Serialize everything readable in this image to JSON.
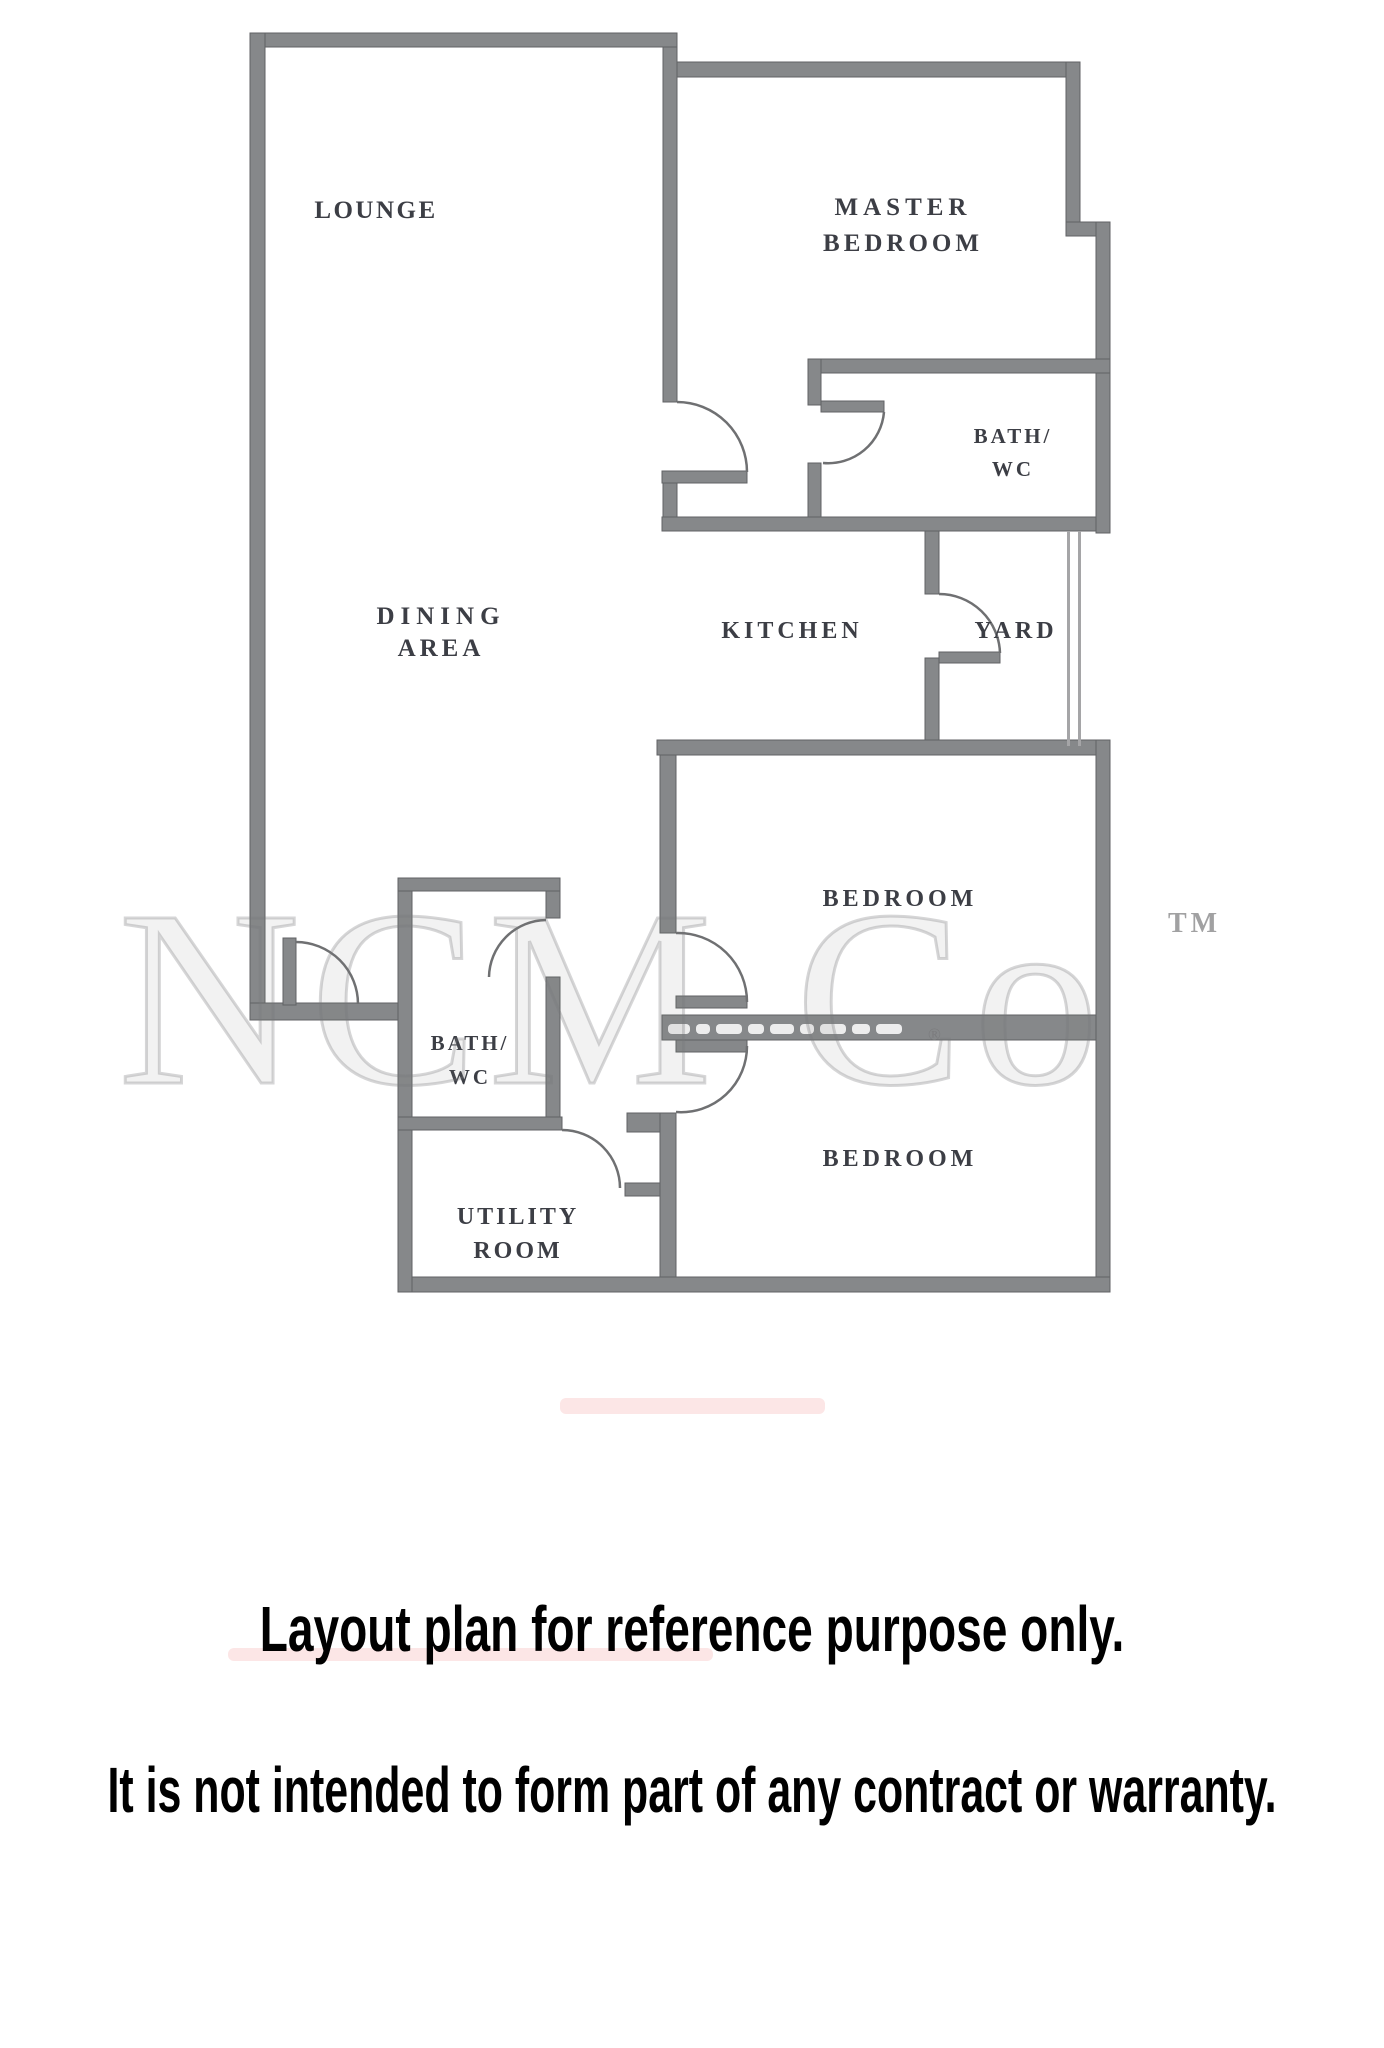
{
  "rooms": {
    "lounge": "LOUNGE",
    "master_line1": "MASTER",
    "master_line2": "BEDROOM",
    "bath1_line1": "BATH/",
    "bath1_line2": "WC",
    "dining_line1": "DINING",
    "dining_line2": "AREA",
    "kitchen": "KITCHEN",
    "yard": "YARD",
    "bedroom_mid": "BEDROOM",
    "bath2_line1": "BATH/",
    "bath2_line2": "WC",
    "utility_line1": "UTILITY",
    "utility_line2": "ROOM",
    "bedroom_bottom": "BEDROOM"
  },
  "watermark": {
    "brand": "NCM Co",
    "tm_symbol": "TM",
    "registered_symbol": "®"
  },
  "footer": {
    "line1": "Layout plan for reference purpose only.",
    "line2": "It is not intended to form part of any contract or warranty."
  },
  "colors": {
    "wall_fill": "#86888a",
    "wall_edge": "#606264",
    "label_text": "#3c3e45",
    "footer_text": "#000000"
  }
}
